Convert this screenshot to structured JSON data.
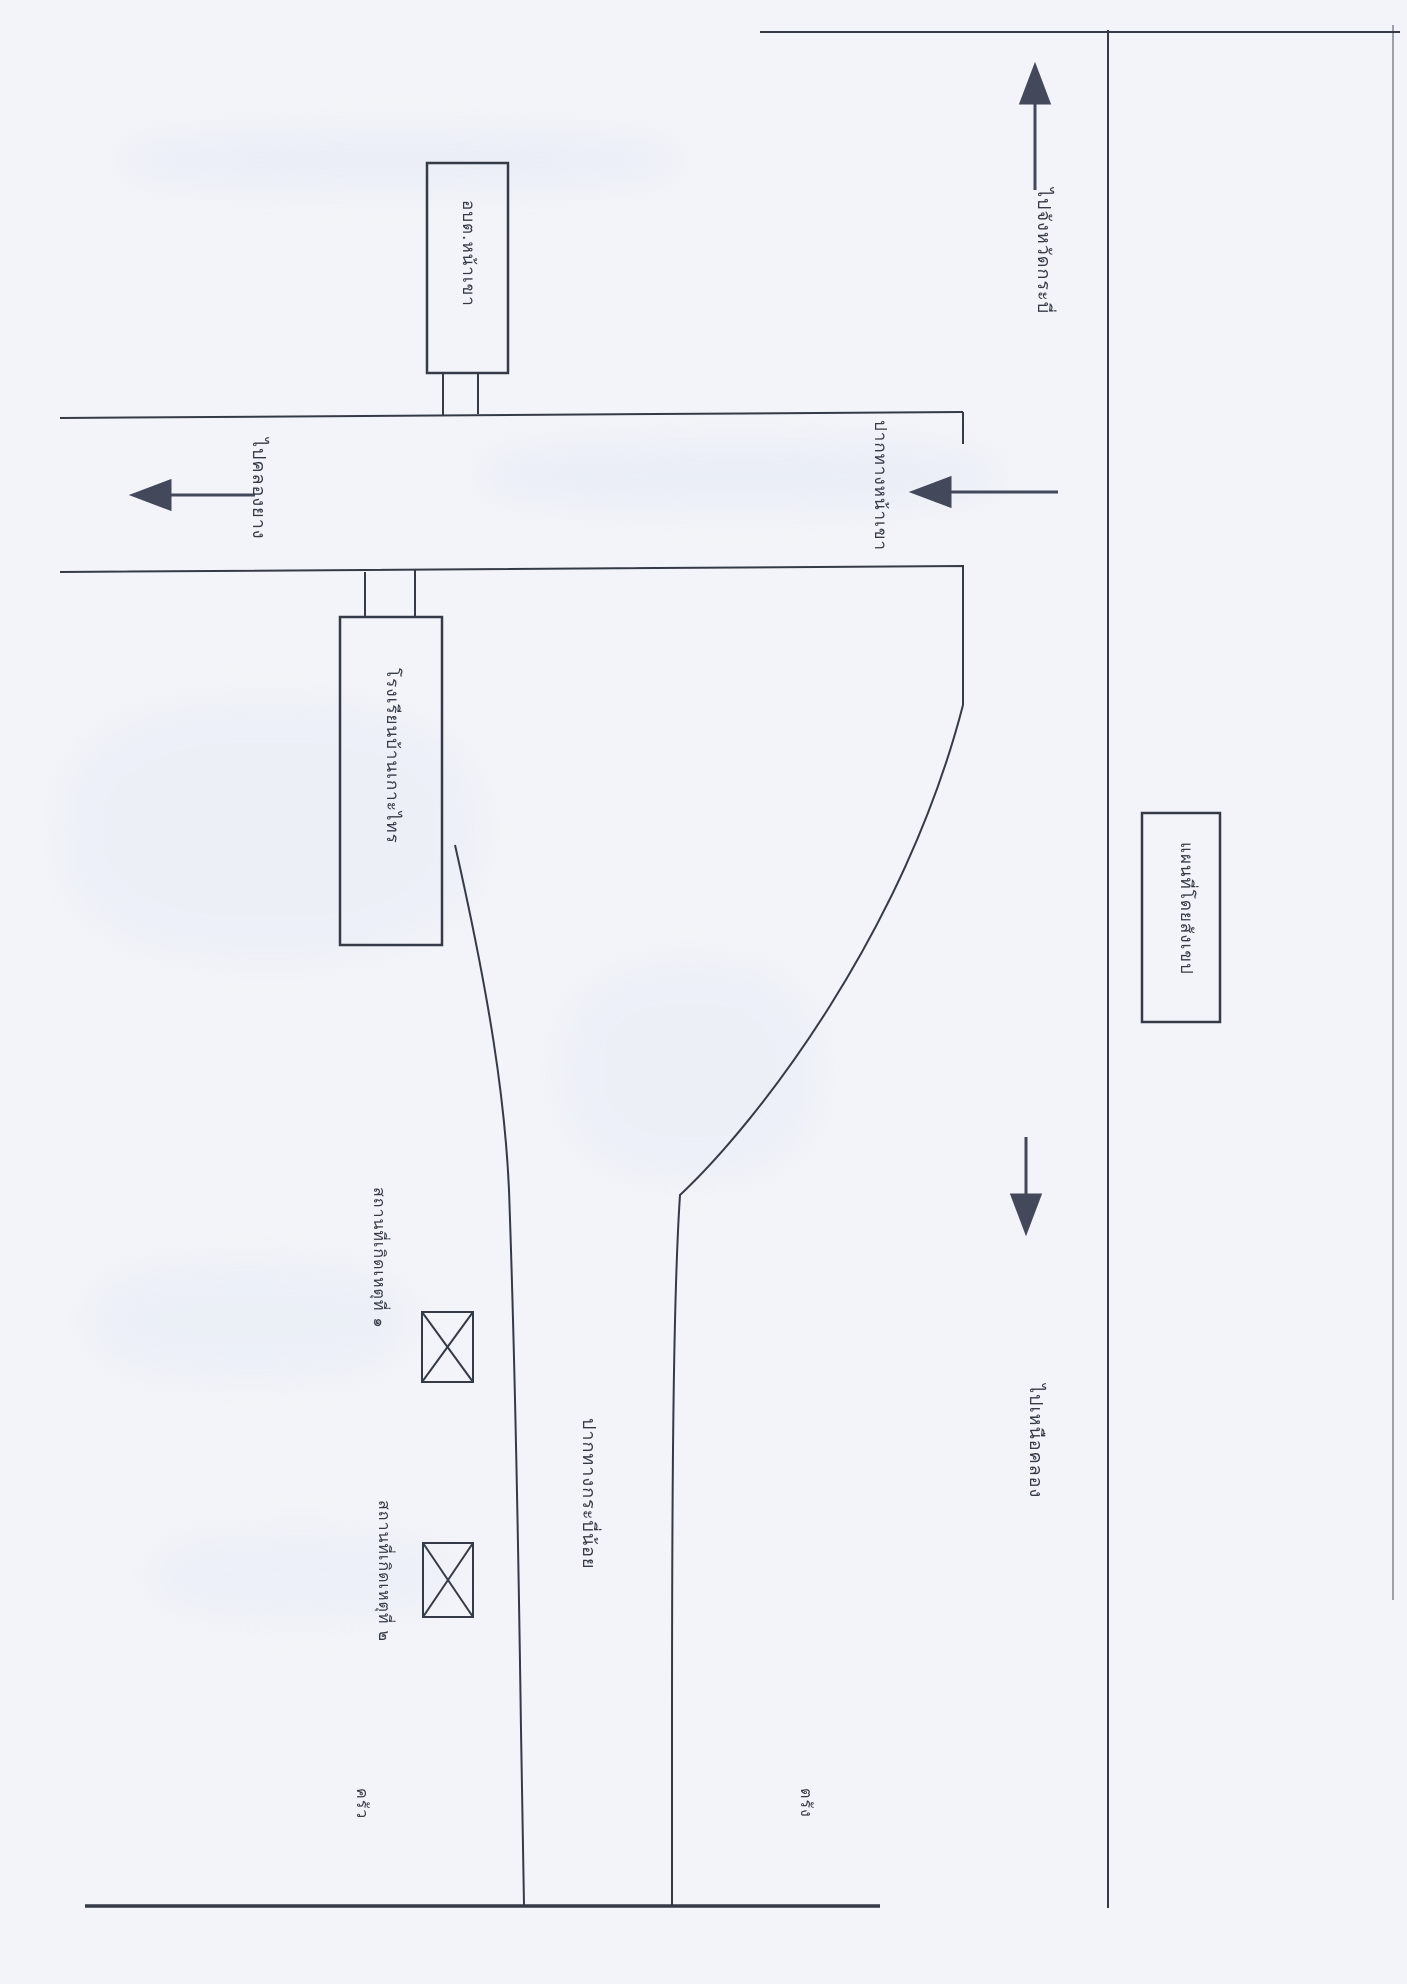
{
  "map": {
    "buildings": {
      "sao_box_label": "อบต.หน้าเขา",
      "school_box_label": "โรงเรียนบ้านเกาะไทร",
      "legend_box_label": "แผนที่โดยสังเขป"
    },
    "road_labels": {
      "to_khlong_yang": "ไปคลองยาง",
      "junction_na_khao": "ปากทางหน้าเขา",
      "to_krabi_province": "ไปจังหวัดกระบี่",
      "to_nuea_khlong": "ไปเหนือคลอง",
      "junction_krabi_noi": "ปากทางกระบี่น้อย"
    },
    "scene_markers": {
      "scene_1_label": "สถานที่เกิดเหตุที่ ๑",
      "scene_2_label": "สถานที่เกิดเหตุที่ ๒"
    },
    "small_notes": {
      "bottom_left": "ครัว",
      "bottom_right": "ตรัง"
    },
    "colors": {
      "ink": "#343a46",
      "paper": "#f3f4f9"
    }
  }
}
